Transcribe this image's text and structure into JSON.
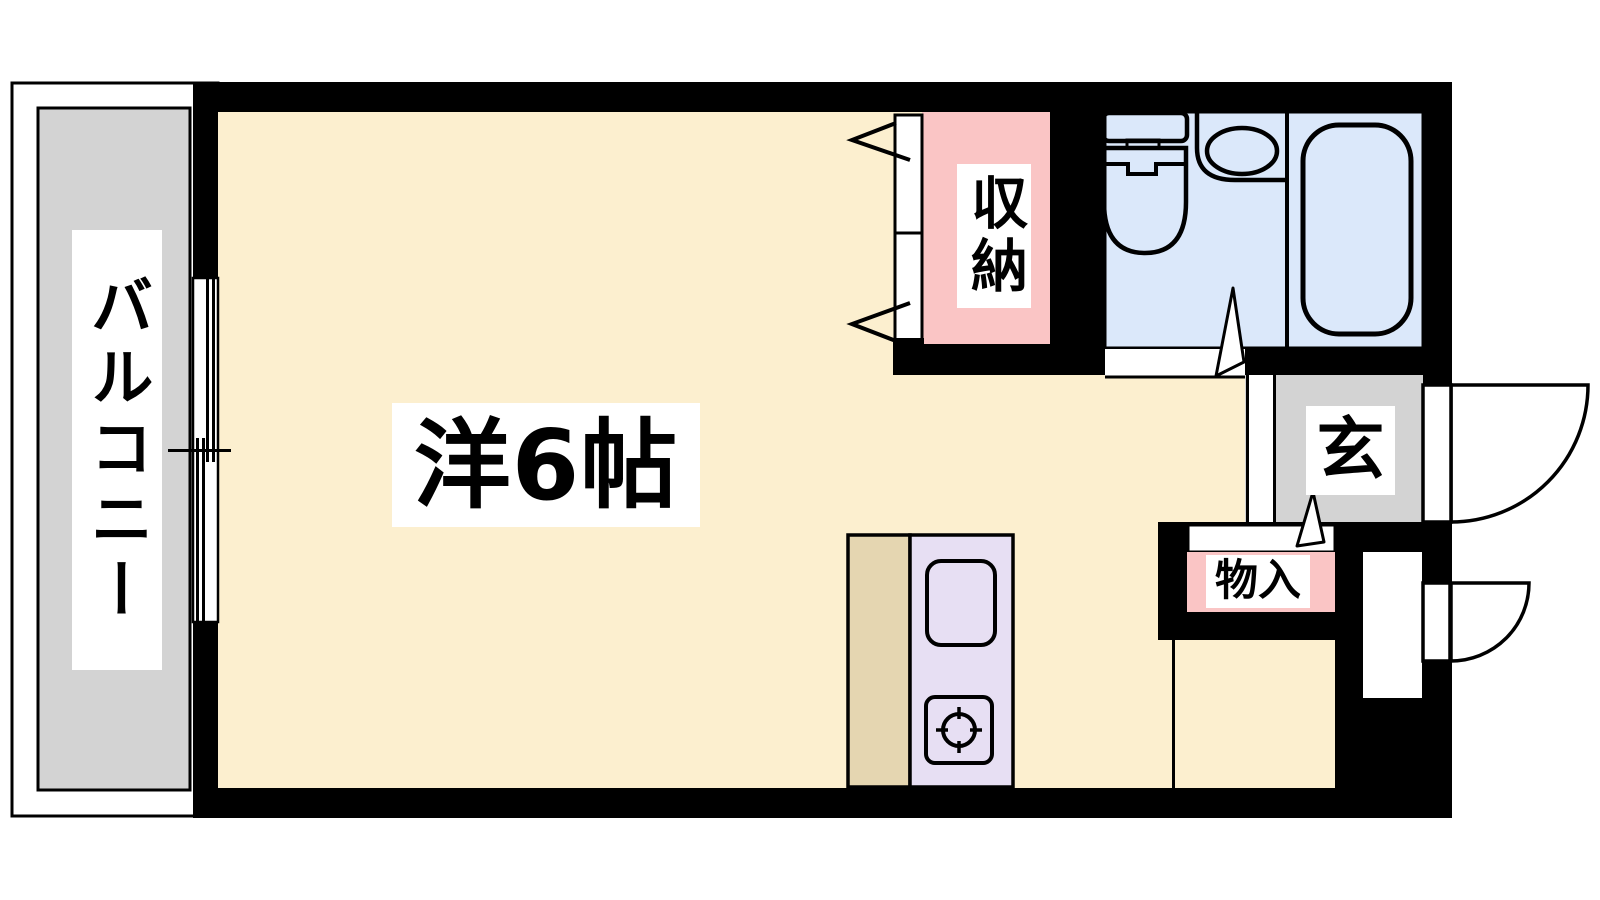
{
  "document": {
    "type": "apartment floor plan",
    "style": "Japanese real-estate madori diagram"
  },
  "labels": {
    "balcony": "バルコニー",
    "main_room": "洋6帖",
    "closet": "収納",
    "entrance": "玄",
    "storage": "物入"
  },
  "colors": {
    "background": "#FFFFFF",
    "wall": "#000000",
    "line": "#000000",
    "room_floor": "#FCEFCF",
    "balcony_floor": "#D3D3D3",
    "entrance_floor": "#D3D3D3",
    "closet_fill": "#FAC5C5",
    "storage_fill": "#FAC5C5",
    "bathroom_floor": "#DBE8FA",
    "kitchen_unit": "#E7DFF3",
    "kitchen_counter": "#E5D6B1",
    "label_background": "#FFFFFF",
    "label_text": "#000000"
  },
  "fixtures": {
    "bathroom": [
      "toilet-icon",
      "wash-basin-icon",
      "bathtub-icon"
    ],
    "kitchen": [
      "kitchen-sink-icon",
      "stove-burner-icon"
    ],
    "openings": [
      "sliding-window-icon",
      "entrance-door-swing-icon",
      "service-door-swing-icon",
      "folding-closet-door-icon",
      "ajar-door-icon"
    ]
  }
}
